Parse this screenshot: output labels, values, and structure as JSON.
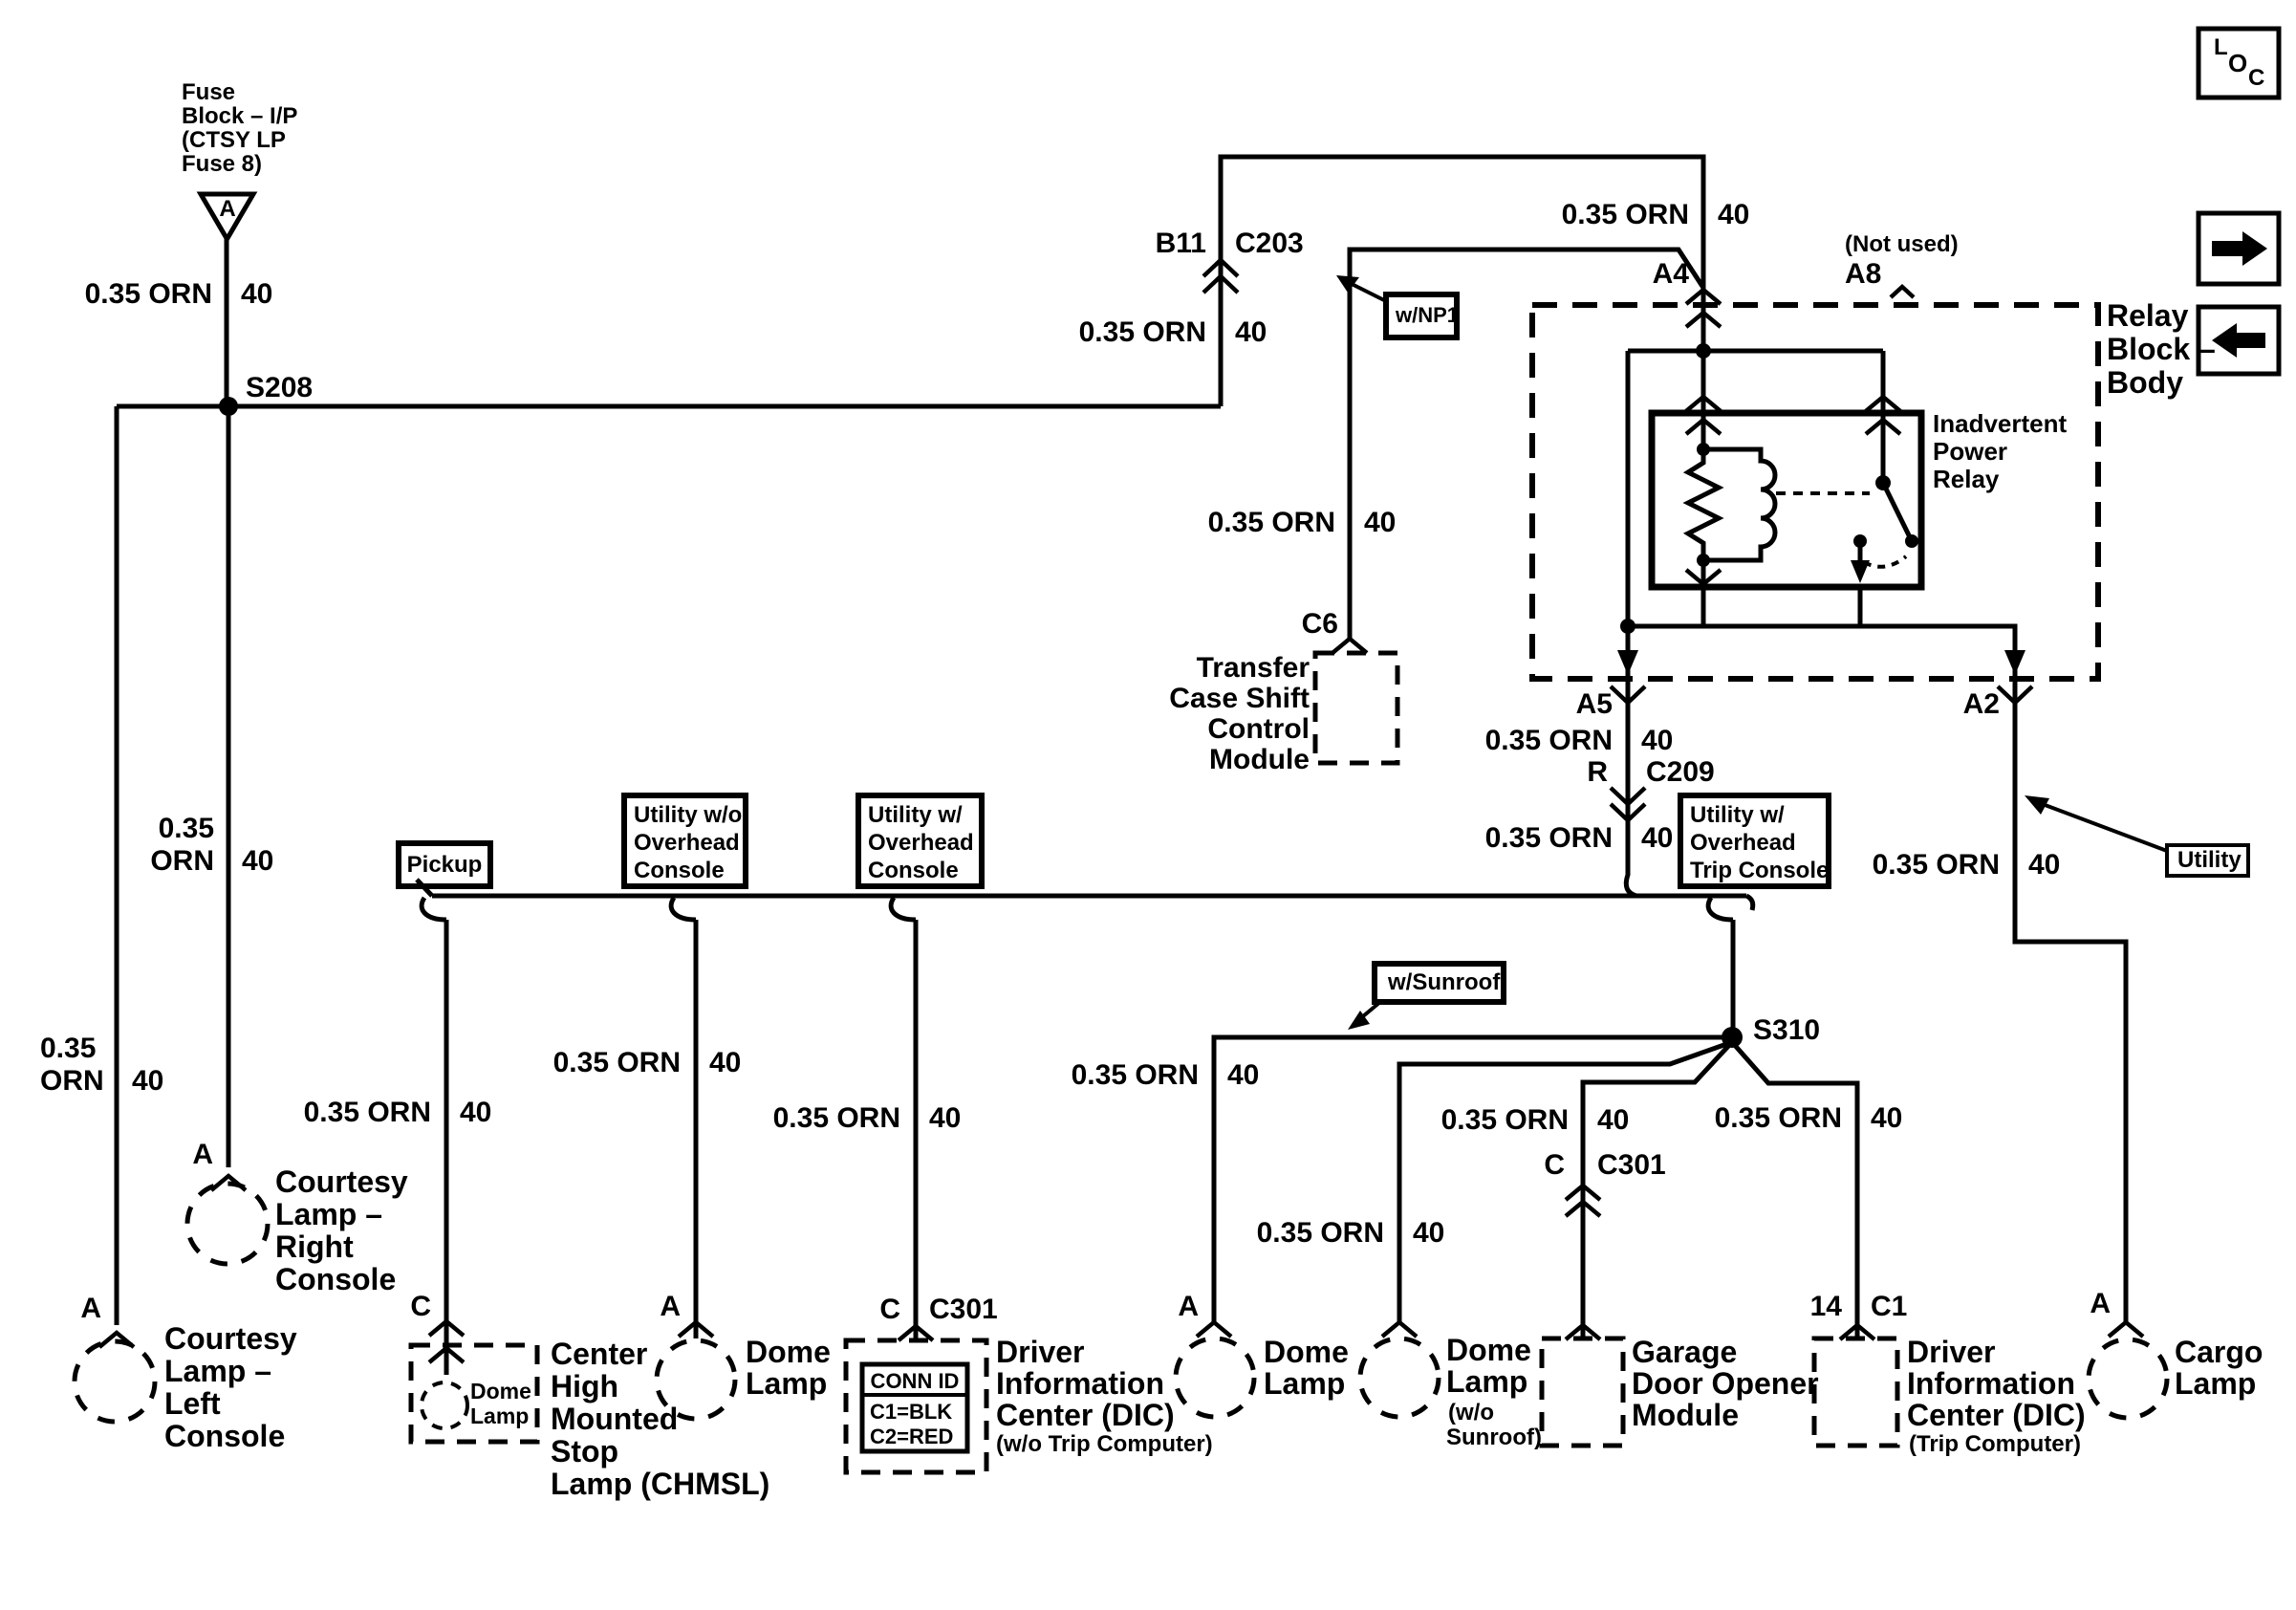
{
  "labels": {
    "wire": "0.35 ORN",
    "wire_line1": "0.35",
    "wire_line2": "ORN",
    "circuit": "40"
  },
  "fuse_block": {
    "lines": [
      "Fuse",
      "Block – I/P",
      "(CTSY LP",
      "Fuse 8)"
    ],
    "terminal": "A"
  },
  "splices": {
    "s208": "S208",
    "s310": "S310"
  },
  "connectors": {
    "b11": "B11",
    "c203": "C203",
    "a4": "A4",
    "a8": "A8",
    "not_used": "(Not used)",
    "a5": "A5",
    "a2": "A2",
    "r": "R",
    "c209": "C209",
    "c6": "C6",
    "c": "C",
    "c301": "C301",
    "pin14": "14",
    "c1": "C1",
    "a": "A"
  },
  "relay": {
    "block": [
      "Relay",
      "Block –",
      "Body"
    ],
    "name": [
      "Inadvertent",
      "Power",
      "Relay"
    ]
  },
  "transfer_case": {
    "lines": [
      "Transfer",
      "Case Shift",
      "Control",
      "Module"
    ]
  },
  "options": {
    "pickup": "Pickup",
    "utility_wo_overhead": [
      "Utility w/o",
      "Overhead",
      "Console"
    ],
    "utility_w_overhead": [
      "Utility w/",
      "Overhead",
      "Console"
    ],
    "utility_w_overhead_trip": [
      "Utility w/",
      "Overhead",
      "Trip Console"
    ]
  },
  "tags": {
    "np1": "w/NP1",
    "sunroof": "w/Sunroof",
    "utility": "Utility"
  },
  "legend": {
    "loc": [
      "L",
      "O",
      "C"
    ]
  },
  "components": {
    "courtesy_left": [
      "Courtesy",
      "Lamp –",
      "Left",
      "Console"
    ],
    "courtesy_right": [
      "Courtesy",
      "Lamp –",
      "Right",
      "Console"
    ],
    "chmsl": [
      "Center",
      "High",
      "Mounted",
      "Stop",
      "Lamp (CHMSL)"
    ],
    "dome_small": [
      "Dome",
      "Lamp"
    ],
    "dome": [
      "Dome",
      "Lamp"
    ],
    "dome_wo_sunroof_note": [
      "(w/o",
      "Sunroof)"
    ],
    "dic": [
      "Driver",
      "Information",
      "Center (DIC)"
    ],
    "dic_wo_note": "(w/o Trip Computer)",
    "dic_trip_note": "(Trip Computer)",
    "garage": [
      "Garage",
      "Door Opener",
      "Module"
    ],
    "cargo": [
      "Cargo",
      "Lamp"
    ],
    "conn_id": {
      "header": "CONN ID",
      "row1": "C1=BLK",
      "row2": "C2=RED"
    }
  }
}
